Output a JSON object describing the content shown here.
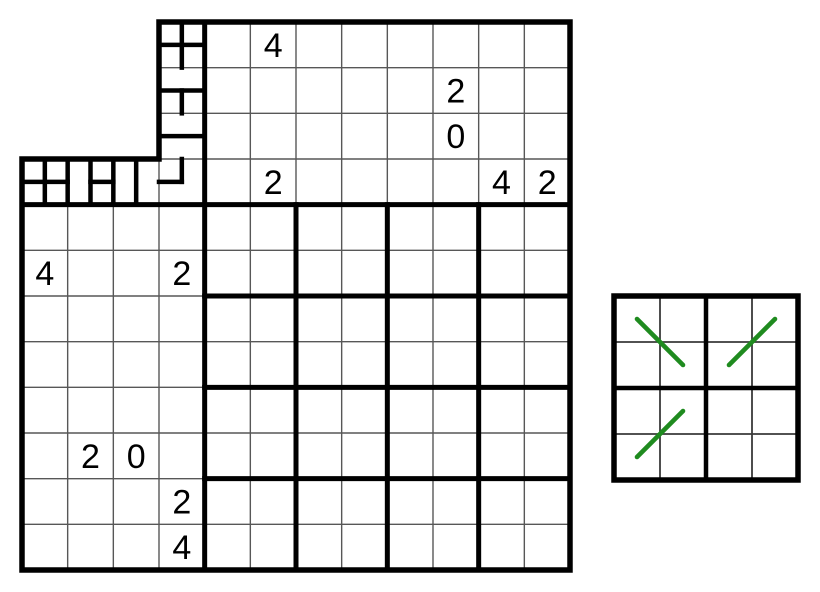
{
  "figure": {
    "width": 820,
    "height": 592,
    "background": "#ffffff"
  },
  "colors": {
    "thick_line": "#000000",
    "thin_line": "#575757",
    "side_inner_line": "#3a3a3a",
    "clue_text": "#000000",
    "green_accent": "#1f8b1f"
  },
  "main_grid": {
    "origin": [
      22,
      22
    ],
    "size_px": 548,
    "units": 24,
    "outer_boundary_units": [
      [
        6,
        0
      ],
      [
        24,
        0
      ],
      [
        24,
        24
      ],
      [
        0,
        24
      ],
      [
        0,
        6
      ],
      [
        6,
        6
      ]
    ],
    "region_border_segments": [
      [
        8,
        0,
        8,
        24
      ],
      [
        0,
        8,
        24,
        8
      ],
      [
        12,
        8,
        12,
        24
      ],
      [
        16,
        8,
        16,
        24
      ],
      [
        20,
        8,
        20,
        24
      ],
      [
        8,
        12,
        24,
        12
      ],
      [
        8,
        16,
        24,
        16
      ],
      [
        8,
        20,
        24,
        20
      ]
    ],
    "thin_line_segments": [
      [
        2,
        8,
        2,
        24
      ],
      [
        4,
        8,
        4,
        24
      ],
      [
        6,
        6,
        6,
        24
      ],
      [
        10,
        0,
        10,
        24
      ],
      [
        14,
        0,
        14,
        24
      ],
      [
        18,
        0,
        18,
        24
      ],
      [
        22,
        0,
        22,
        24
      ],
      [
        12,
        0,
        12,
        8
      ],
      [
        16,
        0,
        16,
        8
      ],
      [
        20,
        0,
        20,
        8
      ],
      [
        6,
        2,
        24,
        2
      ],
      [
        6,
        4,
        24,
        4
      ],
      [
        6,
        6,
        24,
        6
      ],
      [
        0,
        10,
        24,
        10
      ],
      [
        0,
        14,
        24,
        14
      ],
      [
        0,
        18,
        24,
        18
      ],
      [
        0,
        22,
        24,
        22
      ],
      [
        0,
        12,
        8,
        12
      ],
      [
        0,
        16,
        8,
        16
      ],
      [
        0,
        20,
        8,
        20
      ]
    ],
    "drawn_wall_segments": [
      [
        7,
        0,
        7,
        2
      ],
      [
        6,
        1,
        8,
        1
      ],
      [
        6,
        3,
        8,
        3
      ],
      [
        7,
        3,
        7,
        4
      ],
      [
        6,
        5,
        8,
        5
      ],
      [
        7,
        6,
        7,
        7
      ],
      [
        6,
        7,
        7,
        7
      ],
      [
        0,
        7,
        2,
        7
      ],
      [
        3,
        7,
        4,
        7
      ],
      [
        1,
        6,
        1,
        8
      ],
      [
        2,
        6,
        2,
        8
      ],
      [
        3,
        6,
        3,
        8
      ],
      [
        4,
        6,
        4,
        8
      ],
      [
        5,
        6,
        5,
        8
      ]
    ],
    "clues": [
      {
        "row": 1,
        "col": 6,
        "value": "4"
      },
      {
        "row": 2,
        "col": 10,
        "value": "2"
      },
      {
        "row": 3,
        "col": 10,
        "value": "0"
      },
      {
        "row": 4,
        "col": 6,
        "value": "2"
      },
      {
        "row": 4,
        "col": 11,
        "value": "4"
      },
      {
        "row": 4,
        "col": 12,
        "value": "2"
      },
      {
        "row": 6,
        "col": 1,
        "value": "4"
      },
      {
        "row": 6,
        "col": 4,
        "value": "2"
      },
      {
        "row": 10,
        "col": 2,
        "value": "2"
      },
      {
        "row": 10,
        "col": 3,
        "value": "0"
      },
      {
        "row": 11,
        "col": 4,
        "value": "2"
      },
      {
        "row": 12,
        "col": 4,
        "value": "4"
      }
    ]
  },
  "side_grid": {
    "left": 614,
    "top": 296,
    "cell": 46,
    "cols": 4,
    "rows": 4,
    "green_diagonals": [
      {
        "from_cell": [
          1,
          1
        ],
        "to_cell": [
          2,
          2
        ]
      },
      {
        "from_cell": [
          2,
          3
        ],
        "to_cell": [
          1,
          4
        ]
      },
      {
        "from_cell": [
          4,
          1
        ],
        "to_cell": [
          3,
          2
        ]
      }
    ]
  }
}
